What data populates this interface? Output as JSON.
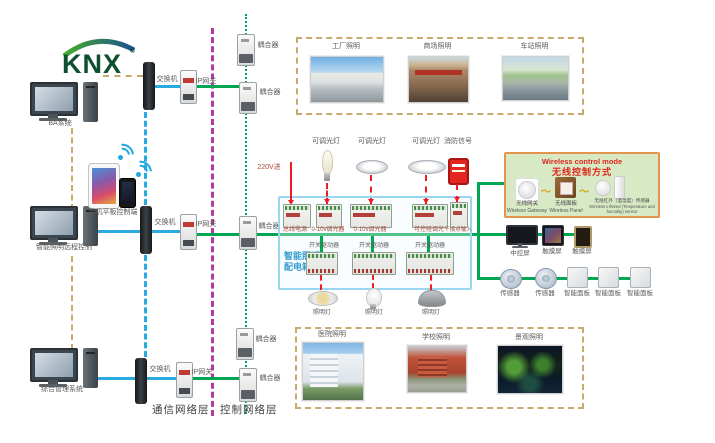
{
  "logo": {
    "text": "KNX",
    "reg": "®"
  },
  "left_column": {
    "ba_system": "BA系统",
    "mobile_label": "手机平板控制端",
    "remote_control": "智能照明远程控制",
    "management": "综合管理系统"
  },
  "network": {
    "switch": "交换机",
    "ip_gateway": "IP网关",
    "coupler": "耦合器"
  },
  "layers": {
    "communication": "通信网络层",
    "control": "控制网络层"
  },
  "cabinet": {
    "name_line1": "智能照明",
    "name_line2": "配电箱",
    "power_in": "220V进",
    "devices_top": [
      "总线电源",
      "0-10v调光器",
      "0-10v调光器",
      "可控硅调光",
      "干接点输入"
    ],
    "loads_top": [
      "可调光灯",
      "可调光灯",
      "可调光灯",
      "消防信号"
    ],
    "devices_bottom": [
      "开关驱动器",
      "开关驱动器",
      "开关驱动器"
    ],
    "loads_bottom": [
      "照明灯",
      "照明灯",
      "照明灯"
    ]
  },
  "wireless": {
    "title_en": "Wireless control mode",
    "title_zh": "无线控制方式",
    "items": [
      {
        "zh": "无线网关",
        "en": "Wireless Gateway"
      },
      {
        "zh": "无线面板",
        "en": "Wireless Panel"
      },
      {
        "zh": "无线红外（温湿度）传感器",
        "en": "Wireless infrared (Temperature and humidity) sensor"
      }
    ]
  },
  "terminals": {
    "row1": [
      "中控屏",
      "触摸屏",
      "触摸屏"
    ],
    "row2": [
      "传感器",
      "传感器",
      "智能面板",
      "智能面板",
      "智能面板"
    ]
  },
  "scenes": {
    "top": [
      "工厂照明",
      "商场照明",
      "车站照明"
    ],
    "bottom": [
      "医院照明",
      "学校照明",
      "景观照明"
    ]
  },
  "colors": {
    "bus_green": "#00a651",
    "comm_blue": "#29abe2",
    "layer_purple": "#b3399c",
    "link_tan": "#c8a96e",
    "power_red": "#ed1c24",
    "cabinet_border": "#99d6f0",
    "wireless_bg": "#d8e9c5",
    "wireless_border": "#e3944d"
  }
}
